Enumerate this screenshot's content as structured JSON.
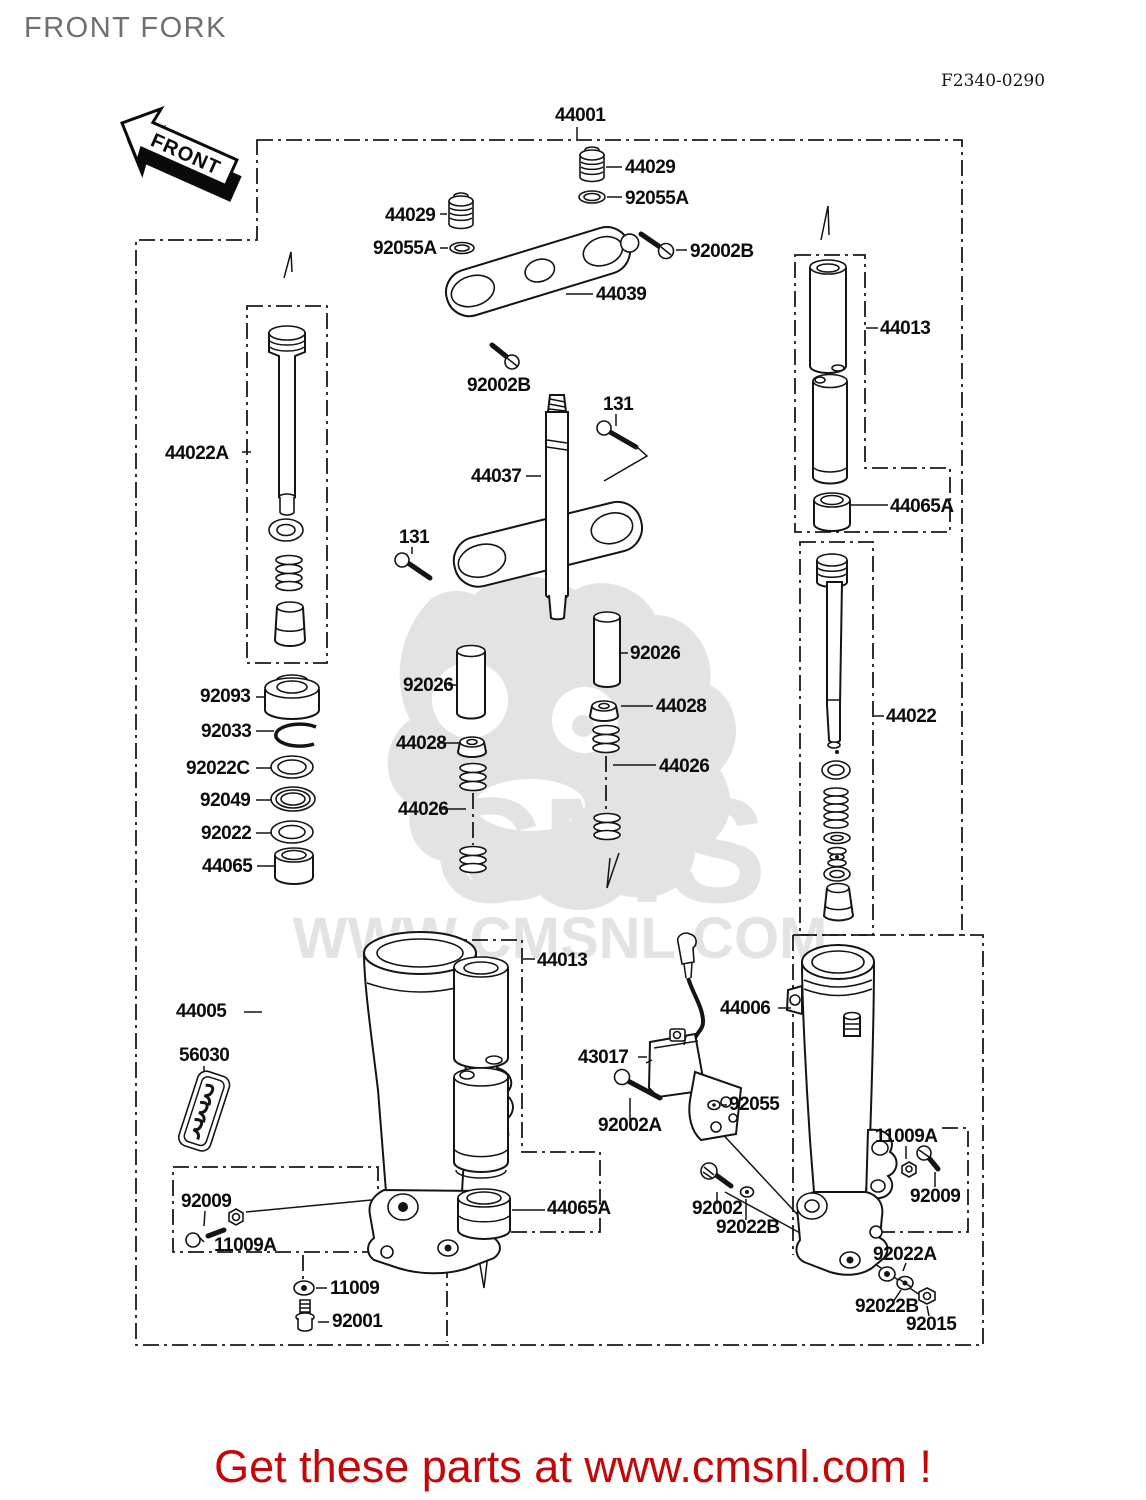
{
  "page": {
    "title": "FRONT FORK",
    "figure_code": "F2340-0290",
    "front_arrow_label": "FRONT",
    "banner_text": "Get these parts at www.cmsnl.com !"
  },
  "colors": {
    "banner_red": "#c40606",
    "title_gray": "#6f6f6f",
    "watermark_gray": "#e3e3e3",
    "line_black": "#141414"
  },
  "watermark": {
    "big_text": "CMS",
    "band_text": "WWW.CMSNL.COM"
  },
  "diagram": {
    "labels": [
      {
        "text": "44001",
        "x": 555,
        "y": 121
      },
      {
        "text": "44029",
        "x": 625,
        "y": 173
      },
      {
        "text": "92055A",
        "x": 625,
        "y": 204
      },
      {
        "text": "44029",
        "x": 385,
        "y": 221
      },
      {
        "text": "92055A",
        "x": 373,
        "y": 254
      },
      {
        "text": "92002B",
        "x": 690,
        "y": 257
      },
      {
        "text": "44039",
        "x": 596,
        "y": 300
      },
      {
        "text": "92002B",
        "x": 467,
        "y": 391
      },
      {
        "text": "131",
        "x": 603,
        "y": 410
      },
      {
        "text": "44037",
        "x": 471,
        "y": 482
      },
      {
        "text": "131",
        "x": 399,
        "y": 543
      },
      {
        "text": "44022A",
        "x": 165,
        "y": 459
      },
      {
        "text": "92093",
        "x": 200,
        "y": 702
      },
      {
        "text": "92033",
        "x": 201,
        "y": 737
      },
      {
        "text": "92022C",
        "x": 186,
        "y": 774
      },
      {
        "text": "92049",
        "x": 200,
        "y": 806
      },
      {
        "text": "92022",
        "x": 201,
        "y": 839
      },
      {
        "text": "44065",
        "x": 202,
        "y": 872
      },
      {
        "text": "92026",
        "x": 403,
        "y": 691
      },
      {
        "text": "44028",
        "x": 396,
        "y": 749
      },
      {
        "text": "44026",
        "x": 398,
        "y": 815
      },
      {
        "text": "92026",
        "x": 630,
        "y": 659
      },
      {
        "text": "44028",
        "x": 656,
        "y": 712
      },
      {
        "text": "44026",
        "x": 659,
        "y": 772
      },
      {
        "text": "44013",
        "x": 880,
        "y": 334
      },
      {
        "text": "44065A",
        "x": 890,
        "y": 512
      },
      {
        "text": "44022",
        "x": 886,
        "y": 722
      },
      {
        "text": "44005",
        "x": 176,
        "y": 1017
      },
      {
        "text": "56030",
        "x": 179,
        "y": 1061
      },
      {
        "text": "92009",
        "x": 181,
        "y": 1207
      },
      {
        "text": "11009A",
        "x": 214,
        "y": 1251
      },
      {
        "text": "11009",
        "x": 330,
        "y": 1294
      },
      {
        "text": "92001",
        "x": 332,
        "y": 1327
      },
      {
        "text": "44013",
        "x": 537,
        "y": 966
      },
      {
        "text": "44065A",
        "x": 547,
        "y": 1214
      },
      {
        "text": "43017",
        "x": 578,
        "y": 1063
      },
      {
        "text": "44006",
        "x": 720,
        "y": 1014
      },
      {
        "text": "92055",
        "x": 729,
        "y": 1110
      },
      {
        "text": "92002A",
        "x": 598,
        "y": 1131
      },
      {
        "text": "92002",
        "x": 692,
        "y": 1214
      },
      {
        "text": "92022B",
        "x": 716,
        "y": 1233
      },
      {
        "text": "11009A",
        "x": 875,
        "y": 1142
      },
      {
        "text": "92009",
        "x": 910,
        "y": 1202
      },
      {
        "text": "92022A",
        "x": 873,
        "y": 1260
      },
      {
        "text": "92022B",
        "x": 855,
        "y": 1312
      },
      {
        "text": "92015",
        "x": 906,
        "y": 1330
      }
    ]
  }
}
